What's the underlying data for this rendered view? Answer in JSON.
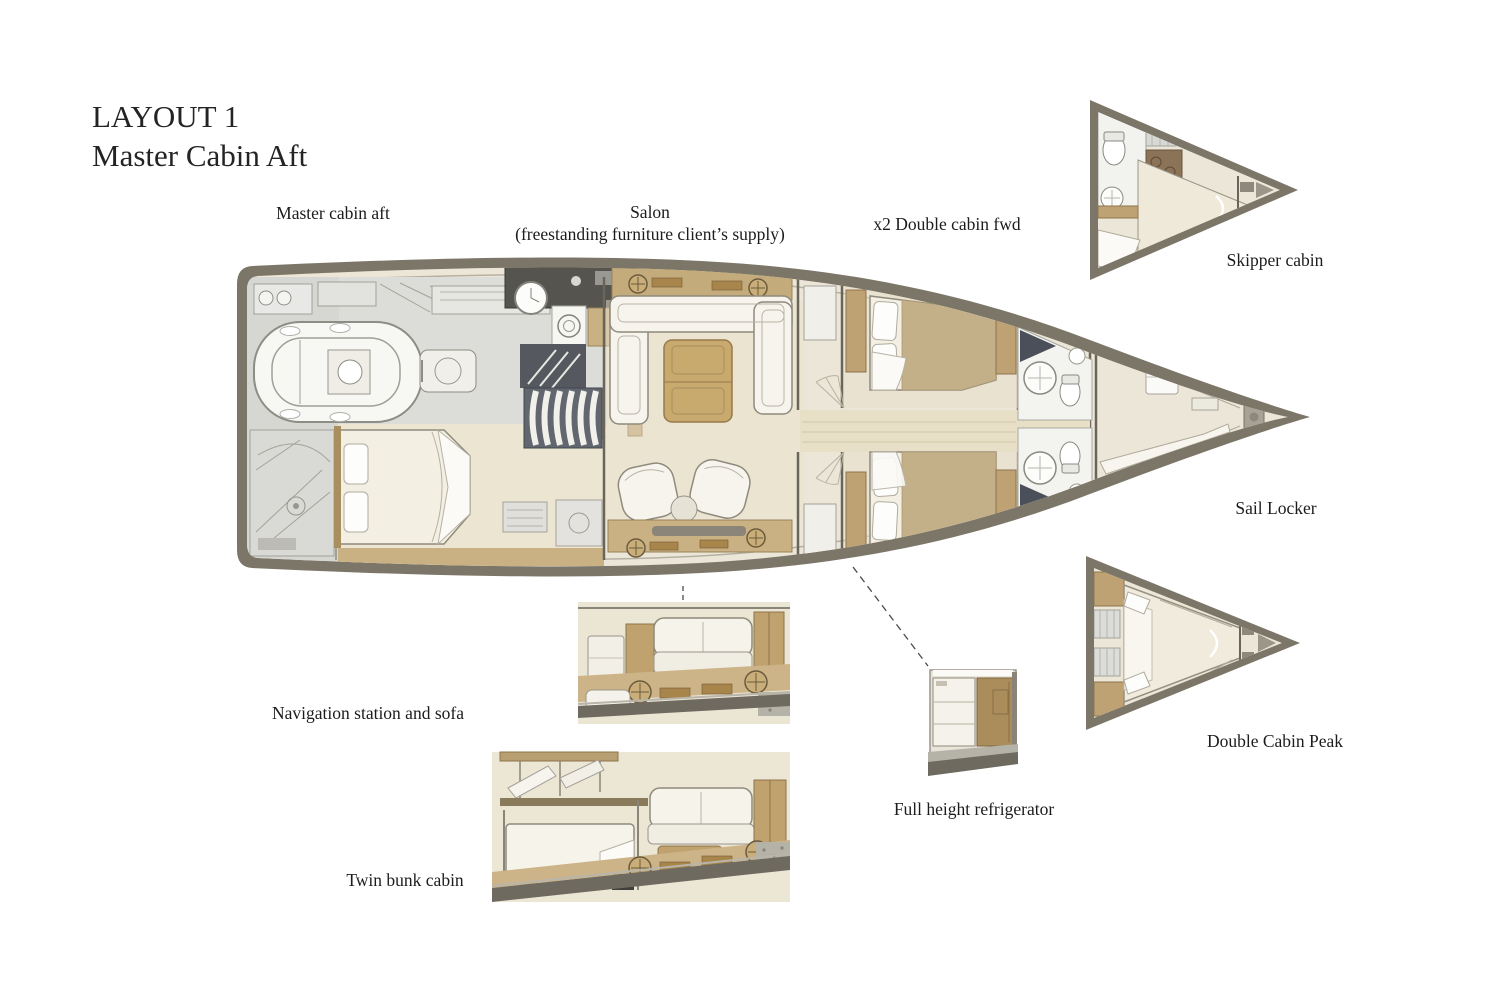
{
  "title": {
    "line1": "LAYOUT 1",
    "line2": "Master Cabin Aft"
  },
  "plan_labels": {
    "master_cabin_aft": "Master cabin aft",
    "salon": "Salon",
    "salon_note": "(freestanding furniture client’s supply)",
    "double_cabin_fwd": "x2 Double cabin fwd",
    "skipper_cabin": "Skipper cabin",
    "sail_locker": "Sail Locker",
    "navigation_station": "Navigation station and sofa",
    "twin_bunk_cabin": "Twin bunk cabin",
    "full_height_refrigerator": "Full height refrigerator",
    "double_cabin_peak": "Double Cabin Peak"
  },
  "colors": {
    "background": "#ffffff",
    "text": "#1f1f1f",
    "hull_rim": "#7c7668",
    "deck_cream": "#ebe6d7",
    "wood_tan": "#c9b184",
    "vent_gold": "#a8854a",
    "furniture_white": "#f5f3ea",
    "technical_gray": "#dcdcd9",
    "floor_beige": "#e7dfca",
    "dark_base": "#6e6a60",
    "stairs_dark": "#5a5e66"
  }
}
